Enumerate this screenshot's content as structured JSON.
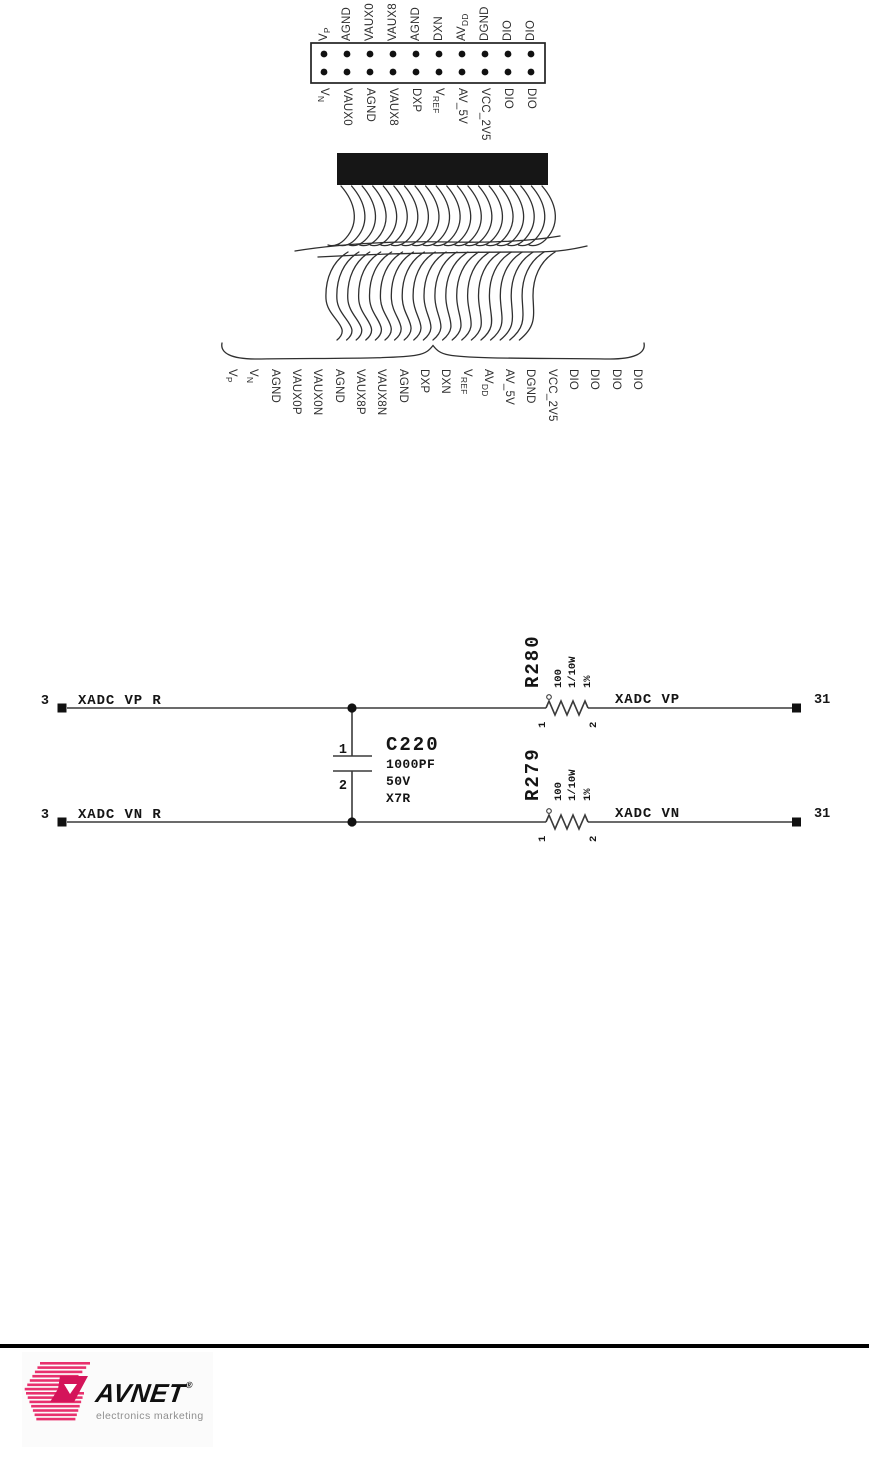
{
  "page": {
    "width": 869,
    "height": 1467,
    "background": "#ffffff"
  },
  "header_connector": {
    "pins_per_row": 10,
    "top_row": [
      {
        "t": "V",
        "s": "P"
      },
      {
        "t": "AGND"
      },
      {
        "t": "VAUX0"
      },
      {
        "t": "VAUX8"
      },
      {
        "t": "AGND"
      },
      {
        "t": "DXN"
      },
      {
        "t": "AV",
        "s": "DD"
      },
      {
        "t": "DGND"
      },
      {
        "t": "DIO"
      },
      {
        "t": "DIO"
      }
    ],
    "bottom_row": [
      {
        "t": "V",
        "s": "N"
      },
      {
        "t": "VAUX0"
      },
      {
        "t": "AGND"
      },
      {
        "t": "VAUX8"
      },
      {
        "t": "DXP"
      },
      {
        "t": "V",
        "s": "REF"
      },
      {
        "t": "AV_5V"
      },
      {
        "t": "VCC_2V5"
      },
      {
        "t": "DIO"
      },
      {
        "t": "DIO"
      }
    ]
  },
  "ribbon_cable": {
    "wire_count": 20,
    "breakout_labels": [
      {
        "t": "V",
        "s": "P"
      },
      {
        "t": "V",
        "s": "N"
      },
      {
        "t": "AGND"
      },
      {
        "t": "VAUX0P"
      },
      {
        "t": "VAUX0N"
      },
      {
        "t": "AGND"
      },
      {
        "t": "VAUX8P"
      },
      {
        "t": "VAUX8N"
      },
      {
        "t": "AGND"
      },
      {
        "t": "DXP"
      },
      {
        "t": "DXN"
      },
      {
        "t": "V",
        "s": "REF"
      },
      {
        "t": "AV",
        "s": "DD"
      },
      {
        "t": "AV_5V"
      },
      {
        "t": "DGND"
      },
      {
        "t": "VCC_2V5"
      },
      {
        "t": "DIO"
      },
      {
        "t": "DIO"
      },
      {
        "t": "DIO"
      },
      {
        "t": "DIO"
      }
    ]
  },
  "schematic": {
    "left_pin_top": "3",
    "left_pin_bottom": "3",
    "right_pin_top": "31",
    "right_pin_bottom": "31",
    "net_vp_in": "XADC VP R",
    "net_vp_out": "XADC VP",
    "net_vn_in": "XADC VN R",
    "net_vn_out": "XADC VN",
    "capacitor": {
      "ref": "C220",
      "value": "1000PF",
      "voltage": "50V",
      "dielectric": "X7R",
      "pin1": "1",
      "pin2": "2"
    },
    "resistor_top": {
      "ref": "R280",
      "value": "100",
      "power": "1/10W",
      "tolerance": "1%",
      "pin1": "1",
      "pin2": "2"
    },
    "resistor_bottom": {
      "ref": "R279",
      "value": "100",
      "power": "1/10W",
      "tolerance": "1%",
      "pin1": "1",
      "pin2": "2"
    }
  },
  "footer": {
    "brand": "AVNET",
    "registered": "®",
    "tagline": "electronics marketing",
    "accent_color": "#e8316e"
  }
}
